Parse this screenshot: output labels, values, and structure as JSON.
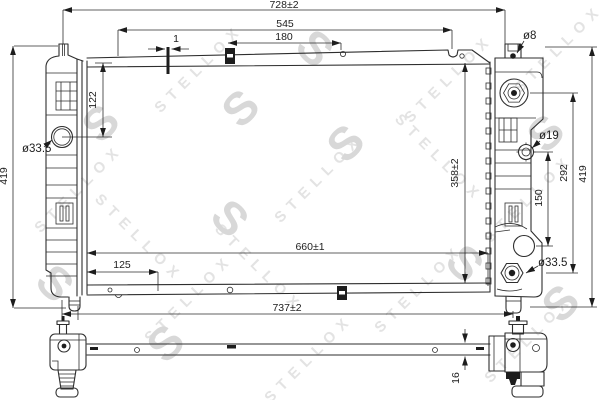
{
  "diagram_type": "radiator-technical-drawing",
  "watermark": {
    "brand": "STELLOX",
    "letter": "S"
  },
  "colors": {
    "line": "#2e2e2e",
    "background": "#ffffff",
    "watermark_brand": "#e3e3e3",
    "watermark_letter": "#d8d8d8"
  },
  "dims": {
    "w728": "728±2",
    "w545": "545",
    "w180": "180",
    "w1": "1",
    "h122": "122",
    "dia33L": "ø33.5",
    "h419L": "419",
    "h358": "358±2",
    "w660": "660±1",
    "w125": "125",
    "w737": "737±2",
    "dia8": "ø8",
    "dia19": "ø19",
    "h292": "292",
    "h419R": "419",
    "h150": "150",
    "dia33R": "ø33.5",
    "t16": "16"
  }
}
